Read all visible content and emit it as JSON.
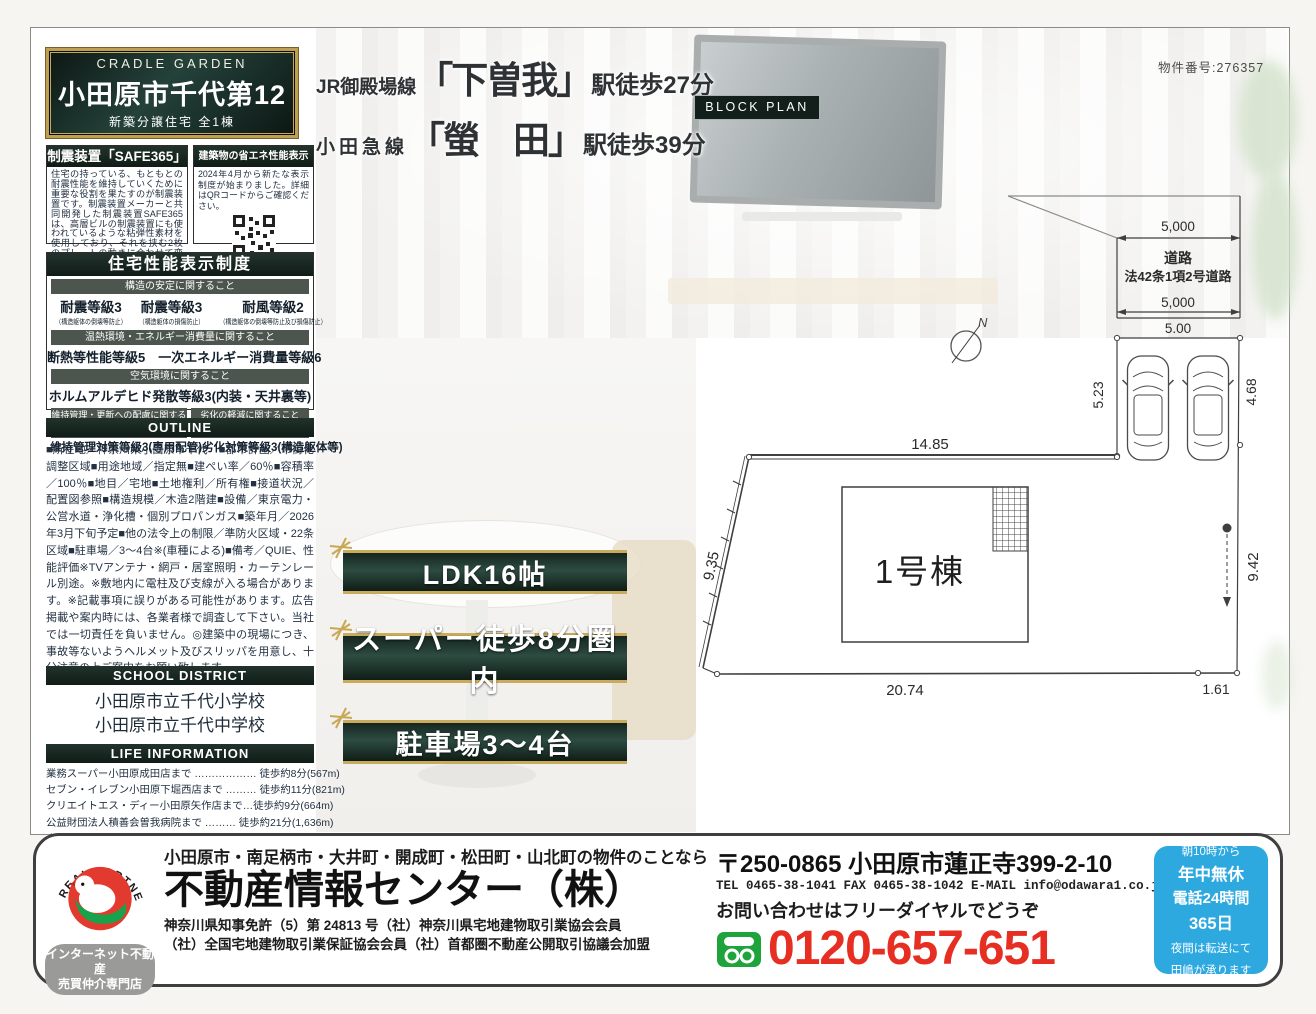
{
  "property_number": "物件番号:276357",
  "plaque": {
    "brand": "CRADLE GARDEN",
    "title": "小田原市千代第12",
    "subtitle": "新築分譲住宅 全1棟"
  },
  "access": {
    "line1": {
      "railway": "JR御殿場線",
      "station": "「下曽我」",
      "walk": "駅徒歩27分"
    },
    "line2": {
      "railway": "小田急線",
      "station": "「螢　田」",
      "walk": "駅徒歩39分"
    }
  },
  "seismic": {
    "title": "制震装置「SAFE365」",
    "body": "住宅の持っている、もともとの耐震性能を維持していくために重要な役割を果たすのが制震装置です。制震装置メーカーと共同開発した制震装置SAFE365は、高層ビルの制震装置にも使われているような粘弾性素材を使用しており、それを挟む2枚のプレートの動きに合わせて変形し地震の揺れを吸収します。"
  },
  "energy": {
    "title": "建築物の省エネ性能表示制度",
    "body": "2024年4月から新たな表示制度が始まりました。詳細はQRコードからご確認ください。"
  },
  "performance": {
    "title": "住宅性能表示制度",
    "s1": {
      "strip": "構造の安定に関すること",
      "g1": "耐震等級3",
      "g1n": "（構造躯体の倒壊等防止）",
      "g2": "耐震等級3",
      "g2n": "（構造躯体の損傷防止）",
      "g3": "耐風等級2",
      "g3n": "（構造躯体の倒壊等防止及び損傷防止）"
    },
    "s2": {
      "strip": "温熱環境・エネルギー消費量に関すること",
      "text": "断熱等性能等級5　一次エネルギー消費量等級6"
    },
    "s3": {
      "strip": "空気環境に関すること",
      "text": "ホルムアルデヒド発散等級3(内装・天井裏等)"
    },
    "s4": {
      "strip_a": "維持管理・更新への配慮に関すること",
      "strip_b": "劣化の軽減に関すること",
      "text_a": "維持管理対策等級3(専用配管)",
      "text_b": "劣化対策等級3(構造躯体等)"
    }
  },
  "outline": {
    "title": "OUTLINE",
    "body": "■所在地／神奈川県小田原市千代　■都市計画／市街化調整区域■用途地域／指定無■建ぺい率／60％■容積率／100％■地目／宅地■土地権利／所有権■接道状況／配置図参照■構造規模／木造2階建■設備／東京電力・公営水道・浄化槽・個別プロパンガス■築年月／2026年3月下旬予定■他の法令上の制限／準防火区域・22条区域■駐車場／3〜4台※(車種による)■備考／QUIE、性能評価※TVアンテナ・網戸・居室照明・カーテンレール別途。※敷地内に電柱及び支線が入る場合があります。※記載事項に誤りがある可能性があります。広告掲載や案内時には、各業者様で調査して下さい。当社では一切責任を負いません。◎建築中の現場につき、事故等ないようヘルメット及びスリッパを用意し、十分注意の上ご案内をお願い致します。"
  },
  "school": {
    "title": "SCHOOL DISTRICT",
    "items": [
      "小田原市立千代小学校",
      "小田原市立千代中学校"
    ]
  },
  "life": {
    "title": "LIFE INFORMATION",
    "items": [
      "業務スーパー小田原成田店まで ……………… 徒歩約8分(567m)",
      "セブン・イレブン小田原下堀西店まで ……… 徒歩約11分(821m)",
      "クリエイトエス・ディー小田原矢作店まで…徒歩約9分(664m)",
      "公益財団法人積善会曽我病院まで ……… 徒歩約21分(1,636m)",
      "小田原成田郵便局まで …………………… 徒歩約13分(1,023m)"
    ]
  },
  "banners": {
    "b1": "LDK16帖",
    "b2": "スーパー徒歩8分圏内",
    "b3": "駐車場3〜4台"
  },
  "block_plan": {
    "label": "BLOCK PLAN",
    "road_line1": "道路",
    "road_line2": "法42条1項2号道路",
    "dim_road_top": "5,000",
    "dim_road_bottom": "5,000",
    "dim_frontage": "5.00",
    "dim_park_left": "5.23",
    "dim_park_right": "4.68",
    "dim_top": "14.85",
    "dim_left": "9.35",
    "dim_right": "9.42",
    "dim_bottom": "20.74",
    "dim_bottom_right": "1.61",
    "building": "1号棟",
    "compass": "N"
  },
  "footer": {
    "logo_arc": "REAL PARTNER",
    "badge_line1": "インターネット不動産",
    "badge_line2": "売買仲介専門店",
    "area_line": "小田原市・南足柄市・大井町・開成町・松田町・山北町の物件のことなら",
    "company": "不動産情報センター（株）",
    "license_line1": "神奈川県知事免許（5）第 24813 号（社）神奈川県宅地建物取引業協会会員",
    "license_line2": "（社）全国宅地建物取引業保証協会会員（社）首都圏不動産公開取引協議会加盟",
    "address": "〒250-0865 小田原市蓮正寺399-2-10",
    "contact_line": "TEL 0465-38-1041 FAX 0465-38-1042 E-MAIL info@odawara1.co.jp",
    "inquiry": "お問い合わせはフリーダイヤルでどうぞ",
    "phone": "0120-657-651",
    "hours": [
      "朝10時から",
      "年中無休",
      "電話24時間",
      "365日",
      "夜間は転送にて",
      "田嶋が承ります"
    ]
  },
  "colors": {
    "accent_gold": "#c9ab5e",
    "dark_green": "#1c2b26",
    "phone_red": "#e62e22",
    "freedial_green": "#1fa43c",
    "hours_blue": "#2da9e0"
  }
}
